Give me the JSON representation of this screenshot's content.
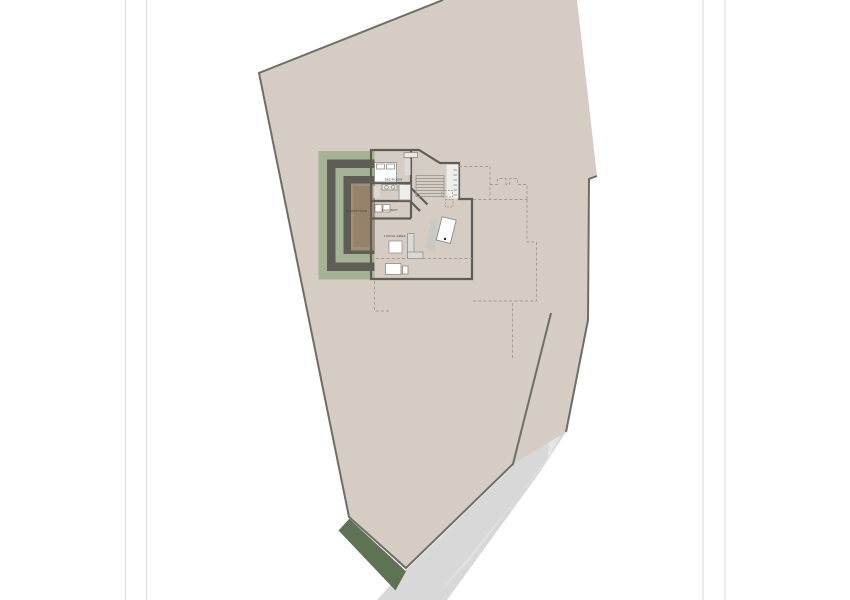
{
  "plan": {
    "labels": {
      "bedroom": "BEDROOM",
      "courtyard": "COURTYARD",
      "laundry": "LAUNDRY",
      "living_area": "LIVING AREA"
    }
  },
  "colors": {
    "background": "#ffffff",
    "fold_line": "#dadada",
    "site_fill": "#d5ccc3",
    "site_border": "#6e6e67",
    "separation_white": "#ffffff",
    "driveway": "#d8d8d8",
    "driveway_light": "#e7e7e7",
    "hedge_green": "#5d7354",
    "band_green": "#a3b394",
    "wall_dark": "#5e5e57",
    "courtyard_outer": "#a28e78",
    "courtyard_inner": "#96826b",
    "floor": "#fcfcfb",
    "hatch_floor": "#ededea",
    "furniture_fill": "#ffffff",
    "furniture_stroke": "#8b8b85",
    "furniture_shadow": "#c9c9c3",
    "couch_fill": "#d9d9d3",
    "appliance_fill": "#e8e8e4",
    "closet_fill": "#dcdcd6",
    "stair_line": "#90908a",
    "tick_fill": "#c6c6c0",
    "dashed_line": "#a39b90",
    "label_text": "#3c3c36",
    "table_dot": "#222222"
  }
}
